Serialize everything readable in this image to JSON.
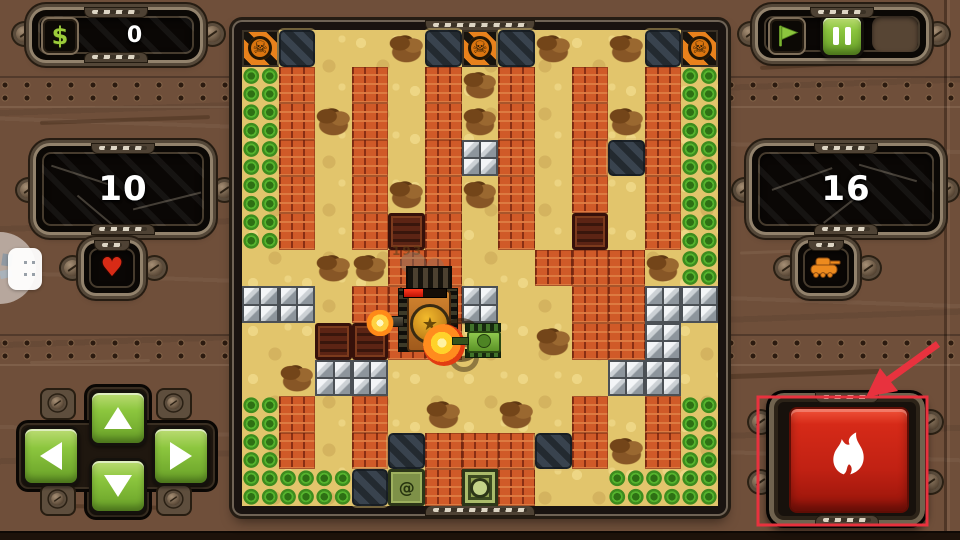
{
  "hud": {
    "money": {
      "icon": "$",
      "value": "0"
    },
    "lives": {
      "value": "10"
    },
    "enemies": {
      "value": "16"
    },
    "damage_popup": "193"
  },
  "battle": {
    "boss_hp_percent": 45
  },
  "icons": {
    "skull": "☠",
    "heart": "♥",
    "star": "★",
    "spawn": "@"
  },
  "board": {
    "cols": 13,
    "rows": 13,
    "glyphs": {
      "sk": "skull",
      "sp": "spawn"
    },
    "legend": {
      "sa": "sand",
      "br": "brick",
      "st": "steel",
      "bu": "bush",
      "ca": "camo-plate",
      "sk": "skull-hazard",
      "de": "debris",
      "cr": "crate",
      "ba": "home-base",
      "sp": "spawn-point"
    },
    "tiles": [
      "sk ca sa sa de ca sk ca de sa de ca sk",
      "bu br sa br sa br de br sa br sa br bu",
      "bu br de br sa br de br sa br de br bu",
      "bu br sa br sa br st br sa br ca br bu",
      "bu br sa br de br de br sa br sa br bu",
      "bu br sa br cr br sa br sa cr sa br bu",
      "sa sa de de br br sa sa br br br de bu",
      "st st sa br br br st sa sa br br st st",
      "sa sa cr cr br br sa sa de br br st sa",
      "sa de st st sa sa sa sa sa sa st st sa",
      "bu br sa br sa de sa de sa br sa br bu",
      "bu br sa br ca br br br ca br de br bu",
      "bu bu bu ca sp br ba br sa sa bu bu bu"
    ]
  },
  "colors": {
    "ui_green": "#8cc63e",
    "fire_red": "#c42016",
    "annotation_red": "#e8323e",
    "brick_orange": "#d05a28"
  },
  "annotation": {
    "kind": "tutorial-pointer",
    "target": "fire-button"
  }
}
